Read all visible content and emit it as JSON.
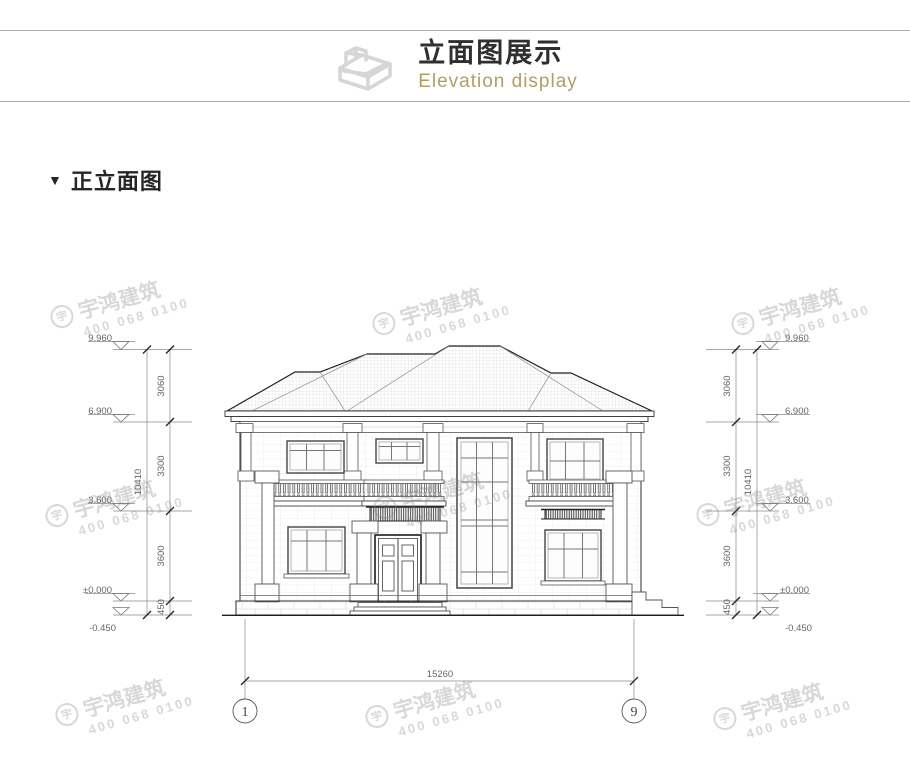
{
  "header": {
    "title": "立面图展示",
    "subtitle": "Elevation display"
  },
  "section": {
    "marker": "▼",
    "title": "正立面图"
  },
  "watermark": {
    "logo_glyph": "宇",
    "brand": "宇鸿建筑",
    "phone": "400 068 0100"
  },
  "dimensions": {
    "levels": [
      "9.960",
      "6.900",
      "3.600",
      "±0.000",
      "-0.450"
    ],
    "chain_heights": [
      "3060",
      "3300",
      "3600",
      "450"
    ],
    "total_height": "10410",
    "total_width": "15260",
    "axis_start": "1",
    "axis_end": "9"
  }
}
